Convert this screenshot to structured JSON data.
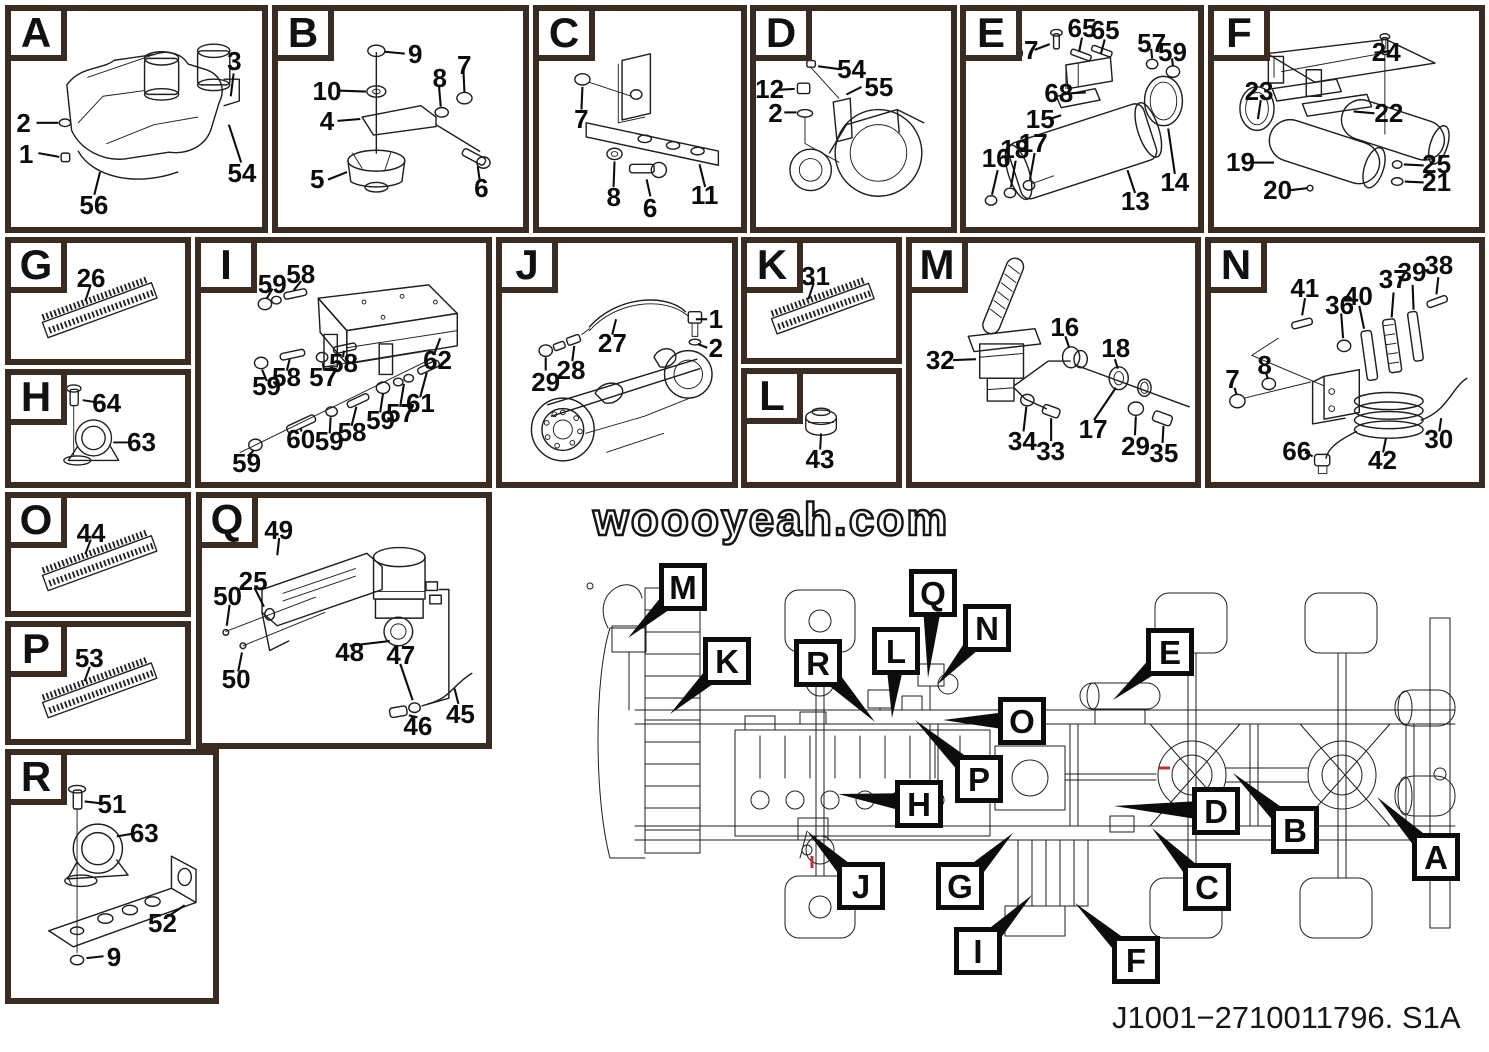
{
  "watermark": "woooyeah.com",
  "part_number": "J1001−2710011796. S1A",
  "colors": {
    "panel_border": "#3a2c21",
    "line": "#1e1e1e",
    "label_border": "#0c0c0c",
    "highlight_red": "#c62f2f"
  },
  "panels": [
    {
      "letter": "A",
      "callouts": [
        {
          "t": "2",
          "x": 5,
          "y": 52
        },
        {
          "t": "1",
          "x": 6,
          "y": 66
        },
        {
          "t": "3",
          "x": 89,
          "y": 23
        },
        {
          "t": "54",
          "x": 92,
          "y": 75
        },
        {
          "t": "56",
          "x": 33,
          "y": 90
        }
      ]
    },
    {
      "letter": "B",
      "callouts": [
        {
          "t": "9",
          "x": 56,
          "y": 20
        },
        {
          "t": "10",
          "x": 20,
          "y": 37
        },
        {
          "t": "4",
          "x": 20,
          "y": 51
        },
        {
          "t": "5",
          "x": 16,
          "y": 78
        },
        {
          "t": "8",
          "x": 66,
          "y": 31
        },
        {
          "t": "7",
          "x": 76,
          "y": 25
        },
        {
          "t": "6",
          "x": 83,
          "y": 82
        }
      ]
    },
    {
      "letter": "C",
      "callouts": [
        {
          "t": "7",
          "x": 21,
          "y": 50
        },
        {
          "t": "8",
          "x": 37,
          "y": 86
        },
        {
          "t": "6",
          "x": 55,
          "y": 91
        },
        {
          "t": "11",
          "x": 82,
          "y": 85
        }
      ]
    },
    {
      "letter": "D",
      "callouts": [
        {
          "t": "54",
          "x": 49,
          "y": 27
        },
        {
          "t": "55",
          "x": 63,
          "y": 35
        },
        {
          "t": "12",
          "x": 7,
          "y": 36
        },
        {
          "t": "2",
          "x": 10,
          "y": 47
        }
      ]
    },
    {
      "letter": "E",
      "callouts": [
        {
          "t": "67",
          "x": 25,
          "y": 18
        },
        {
          "t": "65",
          "x": 50,
          "y": 8
        },
        {
          "t": "65",
          "x": 60,
          "y": 9
        },
        {
          "t": "57",
          "x": 80,
          "y": 15
        },
        {
          "t": "59",
          "x": 89,
          "y": 19
        },
        {
          "t": "68",
          "x": 40,
          "y": 38
        },
        {
          "t": "15",
          "x": 32,
          "y": 50
        },
        {
          "t": "16",
          "x": 13,
          "y": 68
        },
        {
          "t": "18",
          "x": 21,
          "y": 64
        },
        {
          "t": "17",
          "x": 29,
          "y": 61
        },
        {
          "t": "13",
          "x": 73,
          "y": 88
        },
        {
          "t": "14",
          "x": 90,
          "y": 79
        }
      ]
    },
    {
      "letter": "F",
      "callouts": [
        {
          "t": "24",
          "x": 65,
          "y": 19
        },
        {
          "t": "23",
          "x": 17,
          "y": 37
        },
        {
          "t": "22",
          "x": 66,
          "y": 47
        },
        {
          "t": "19",
          "x": 10,
          "y": 70
        },
        {
          "t": "20",
          "x": 24,
          "y": 83
        },
        {
          "t": "25",
          "x": 84,
          "y": 71
        },
        {
          "t": "21",
          "x": 84,
          "y": 79
        }
      ]
    },
    {
      "letter": "G",
      "callouts": [
        {
          "t": "26",
          "x": 46,
          "y": 30
        }
      ]
    },
    {
      "letter": "H",
      "callouts": [
        {
          "t": "64",
          "x": 55,
          "y": 26
        },
        {
          "t": "63",
          "x": 75,
          "y": 63
        }
      ]
    },
    {
      "letter": "I",
      "callouts": [
        {
          "t": "59",
          "x": 25,
          "y": 17
        },
        {
          "t": "58",
          "x": 35,
          "y": 13
        },
        {
          "t": "62",
          "x": 83,
          "y": 49
        },
        {
          "t": "58",
          "x": 30,
          "y": 56
        },
        {
          "t": "59",
          "x": 23,
          "y": 60
        },
        {
          "t": "57",
          "x": 43,
          "y": 56
        },
        {
          "t": "58",
          "x": 50,
          "y": 50
        },
        {
          "t": "59",
          "x": 16,
          "y": 92
        },
        {
          "t": "60",
          "x": 35,
          "y": 82
        },
        {
          "t": "59",
          "x": 45,
          "y": 83
        },
        {
          "t": "58",
          "x": 53,
          "y": 79
        },
        {
          "t": "59",
          "x": 63,
          "y": 74
        },
        {
          "t": "57",
          "x": 70,
          "y": 71
        },
        {
          "t": "61",
          "x": 77,
          "y": 67
        }
      ]
    },
    {
      "letter": "J",
      "callouts": [
        {
          "t": "1",
          "x": 93,
          "y": 32
        },
        {
          "t": "2",
          "x": 93,
          "y": 44
        },
        {
          "t": "27",
          "x": 48,
          "y": 42
        },
        {
          "t": "28",
          "x": 30,
          "y": 53
        },
        {
          "t": "29",
          "x": 19,
          "y": 58
        }
      ]
    },
    {
      "letter": "K",
      "callouts": [
        {
          "t": "31",
          "x": 46,
          "y": 29
        }
      ]
    },
    {
      "letter": "L",
      "callouts": [
        {
          "t": "43",
          "x": 49,
          "y": 79
        }
      ]
    },
    {
      "letter": "M",
      "callouts": [
        {
          "t": "32",
          "x": 10,
          "y": 49
        },
        {
          "t": "16",
          "x": 54,
          "y": 35
        },
        {
          "t": "18",
          "x": 72,
          "y": 44
        },
        {
          "t": "17",
          "x": 64,
          "y": 78
        },
        {
          "t": "34",
          "x": 39,
          "y": 83
        },
        {
          "t": "33",
          "x": 49,
          "y": 87
        },
        {
          "t": "29",
          "x": 79,
          "y": 85
        },
        {
          "t": "35",
          "x": 89,
          "y": 88
        }
      ]
    },
    {
      "letter": "N",
      "callouts": [
        {
          "t": "41",
          "x": 35,
          "y": 19
        },
        {
          "t": "36",
          "x": 48,
          "y": 26
        },
        {
          "t": "40",
          "x": 55,
          "y": 22
        },
        {
          "t": "37",
          "x": 68,
          "y": 15
        },
        {
          "t": "39",
          "x": 75,
          "y": 12
        },
        {
          "t": "38",
          "x": 85,
          "y": 9
        },
        {
          "t": "8",
          "x": 20,
          "y": 51
        },
        {
          "t": "7",
          "x": 8,
          "y": 57
        },
        {
          "t": "66",
          "x": 32,
          "y": 87
        },
        {
          "t": "42",
          "x": 64,
          "y": 91
        },
        {
          "t": "30",
          "x": 85,
          "y": 82
        }
      ]
    },
    {
      "letter": "O",
      "callouts": [
        {
          "t": "44",
          "x": 46,
          "y": 31
        }
      ]
    },
    {
      "letter": "P",
      "callouts": [
        {
          "t": "53",
          "x": 45,
          "y": 28
        }
      ]
    },
    {
      "letter": "Q",
      "callouts": [
        {
          "t": "49",
          "x": 27,
          "y": 13
        },
        {
          "t": "25",
          "x": 18,
          "y": 34
        },
        {
          "t": "50",
          "x": 9,
          "y": 40
        },
        {
          "t": "50",
          "x": 12,
          "y": 74
        },
        {
          "t": "48",
          "x": 52,
          "y": 63
        },
        {
          "t": "47",
          "x": 70,
          "y": 64
        },
        {
          "t": "46",
          "x": 76,
          "y": 93
        },
        {
          "t": "45",
          "x": 91,
          "y": 88
        }
      ]
    },
    {
      "letter": "R",
      "callouts": [
        {
          "t": "51",
          "x": 50,
          "y": 20
        },
        {
          "t": "63",
          "x": 66,
          "y": 32
        },
        {
          "t": "52",
          "x": 75,
          "y": 69
        },
        {
          "t": "9",
          "x": 51,
          "y": 83
        }
      ]
    }
  ],
  "chassis_labels": [
    {
      "letter": "M",
      "x": 659,
      "y": 563,
      "tx": 628,
      "ty": 638
    },
    {
      "letter": "K",
      "x": 703,
      "y": 637,
      "tx": 670,
      "ty": 714
    },
    {
      "letter": "R",
      "x": 794,
      "y": 639,
      "tx": 875,
      "ty": 722
    },
    {
      "letter": "L",
      "x": 872,
      "y": 627,
      "tx": 892,
      "ty": 718
    },
    {
      "letter": "Q",
      "x": 909,
      "y": 569,
      "tx": 928,
      "ty": 678
    },
    {
      "letter": "N",
      "x": 963,
      "y": 604,
      "tx": 937,
      "ty": 685
    },
    {
      "letter": "O",
      "x": 998,
      "y": 697,
      "tx": 943,
      "ty": 720
    },
    {
      "letter": "P",
      "x": 955,
      "y": 755,
      "tx": 915,
      "ty": 720
    },
    {
      "letter": "H",
      "x": 895,
      "y": 780,
      "tx": 838,
      "ty": 794
    },
    {
      "letter": "J",
      "x": 837,
      "y": 862,
      "tx": 807,
      "ty": 831
    },
    {
      "letter": "G",
      "x": 936,
      "y": 862,
      "tx": 1013,
      "ty": 833
    },
    {
      "letter": "I",
      "x": 954,
      "y": 927,
      "tx": 1032,
      "ty": 895
    },
    {
      "letter": "F",
      "x": 1112,
      "y": 936,
      "tx": 1075,
      "ty": 903
    },
    {
      "letter": "C",
      "x": 1183,
      "y": 863,
      "tx": 1152,
      "ty": 828
    },
    {
      "letter": "D",
      "x": 1192,
      "y": 787,
      "tx": 1114,
      "ty": 806
    },
    {
      "letter": "B",
      "x": 1271,
      "y": 806,
      "tx": 1233,
      "ty": 773
    },
    {
      "letter": "E",
      "x": 1146,
      "y": 628,
      "tx": 1113,
      "ty": 700
    },
    {
      "letter": "A",
      "x": 1412,
      "y": 833,
      "tx": 1377,
      "ty": 797
    }
  ]
}
